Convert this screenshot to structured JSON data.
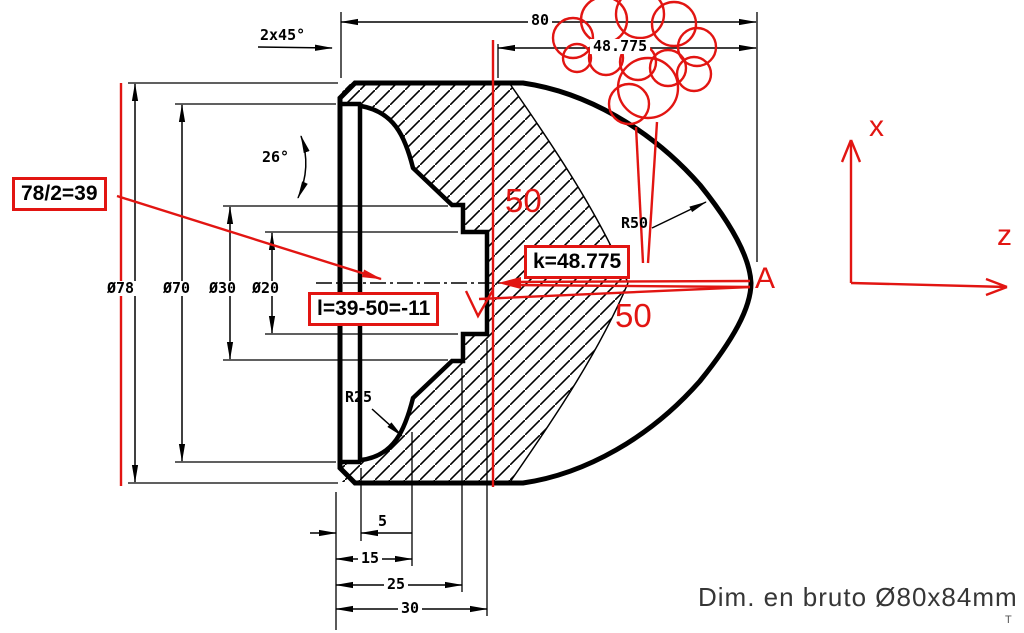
{
  "drawing": {
    "dims": {
      "overall_length": "80",
      "k_length": "48.775",
      "chamfer": "2x45°",
      "cone_angle": "26°",
      "dia_78": "Ø78",
      "dia_70": "Ø70",
      "dia_30": "Ø30",
      "dia_20": "Ø20",
      "radius_25": "R25",
      "radius_50": "R50",
      "depth_5": "5",
      "depth_15": "15",
      "depth_25": "25",
      "depth_30": "30"
    },
    "annotations": {
      "calc_half_diameter": "78/2=39",
      "calc_l": "l=39-50=-11",
      "calc_k": "k=48.775",
      "offset_upper": "50",
      "offset_lower": "50",
      "point_a": "A",
      "axis_x": "x",
      "axis_z": "z"
    },
    "footer": {
      "stock_note": "Dim. en bruto  Ø80x84mm",
      "corner_mark": "T"
    },
    "colors": {
      "annotation_red": "#e21512",
      "line_black": "#000000"
    }
  }
}
